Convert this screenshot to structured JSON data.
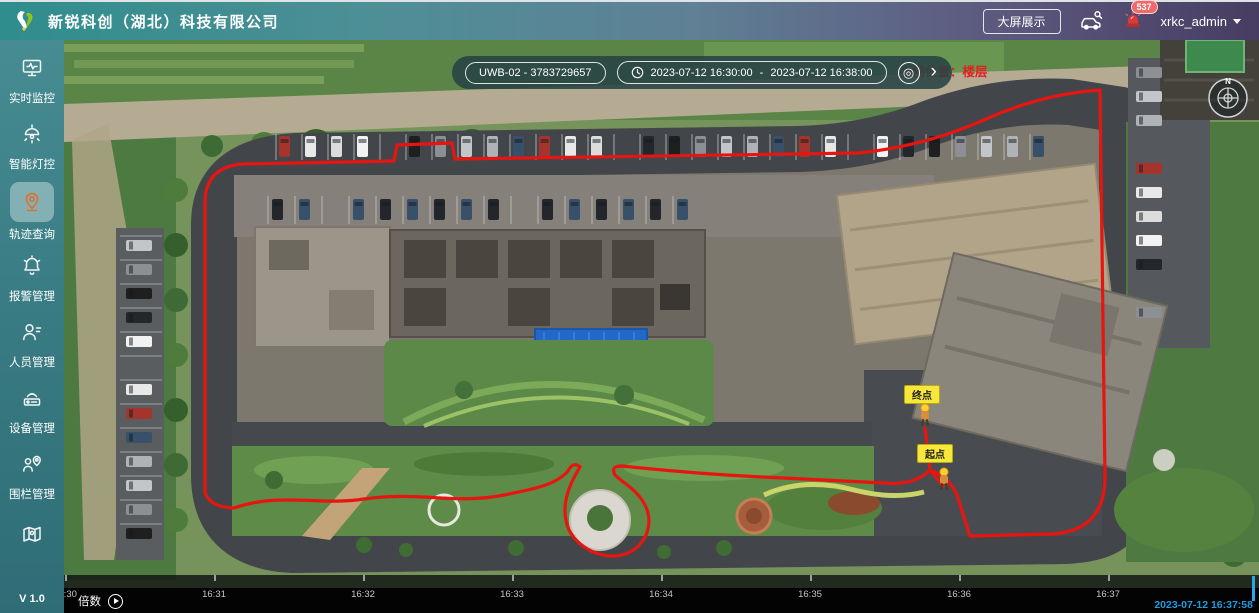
{
  "header": {
    "title": "新锐科创（湖北）科技有限公司",
    "big_screen_button": "大屏展示",
    "alarm_badge": "537",
    "username": "xrkc_admin"
  },
  "sidebar": {
    "items": [
      {
        "label": "实时监控",
        "icon": "monitor-icon",
        "active": false
      },
      {
        "label": "智能灯控",
        "icon": "lamp-icon",
        "active": false
      },
      {
        "label": "轨迹查询",
        "icon": "trajectory-pin-icon",
        "active": true
      },
      {
        "label": "报警管理",
        "icon": "alarm-bell-icon",
        "active": false
      },
      {
        "label": "人员管理",
        "icon": "person-icon",
        "active": false
      },
      {
        "label": "设备管理",
        "icon": "device-icon",
        "active": false
      },
      {
        "label": "围栏管理",
        "icon": "fence-icon",
        "active": false
      },
      {
        "label": "",
        "icon": "map-icon",
        "active": false
      }
    ],
    "version": "V 1.0"
  },
  "query_bar": {
    "device_value": "UWB-02 - 3783729657",
    "time_start": "2023-07-12 16:30:00",
    "time_separator": "-",
    "time_end": "2023-07-12 16:38:00",
    "icons": {
      "locate_glyph": "◎",
      "expand_glyph": "›"
    }
  },
  "map": {
    "current_location_text": "当前位置：楼层",
    "compass_label": "N",
    "end_marker_label": "终点",
    "start_marker_label": "起点"
  },
  "timeline": {
    "speed_label": "倍数",
    "tick_labels": [
      "16:30",
      "16:31",
      "16:32",
      "16:33",
      "16:34",
      "16:35",
      "16:36",
      "16:37"
    ],
    "current_time": "2023-07-12 16:37:58"
  },
  "colors": {
    "accent_teal": "#2f8d8d",
    "sidebar_active_icon": "#e0702b",
    "track_red": "#e81410",
    "marker_yellow": "#f7e73a",
    "playhead_blue": "#2aa7e8",
    "alarm_red": "#e31f1f"
  }
}
